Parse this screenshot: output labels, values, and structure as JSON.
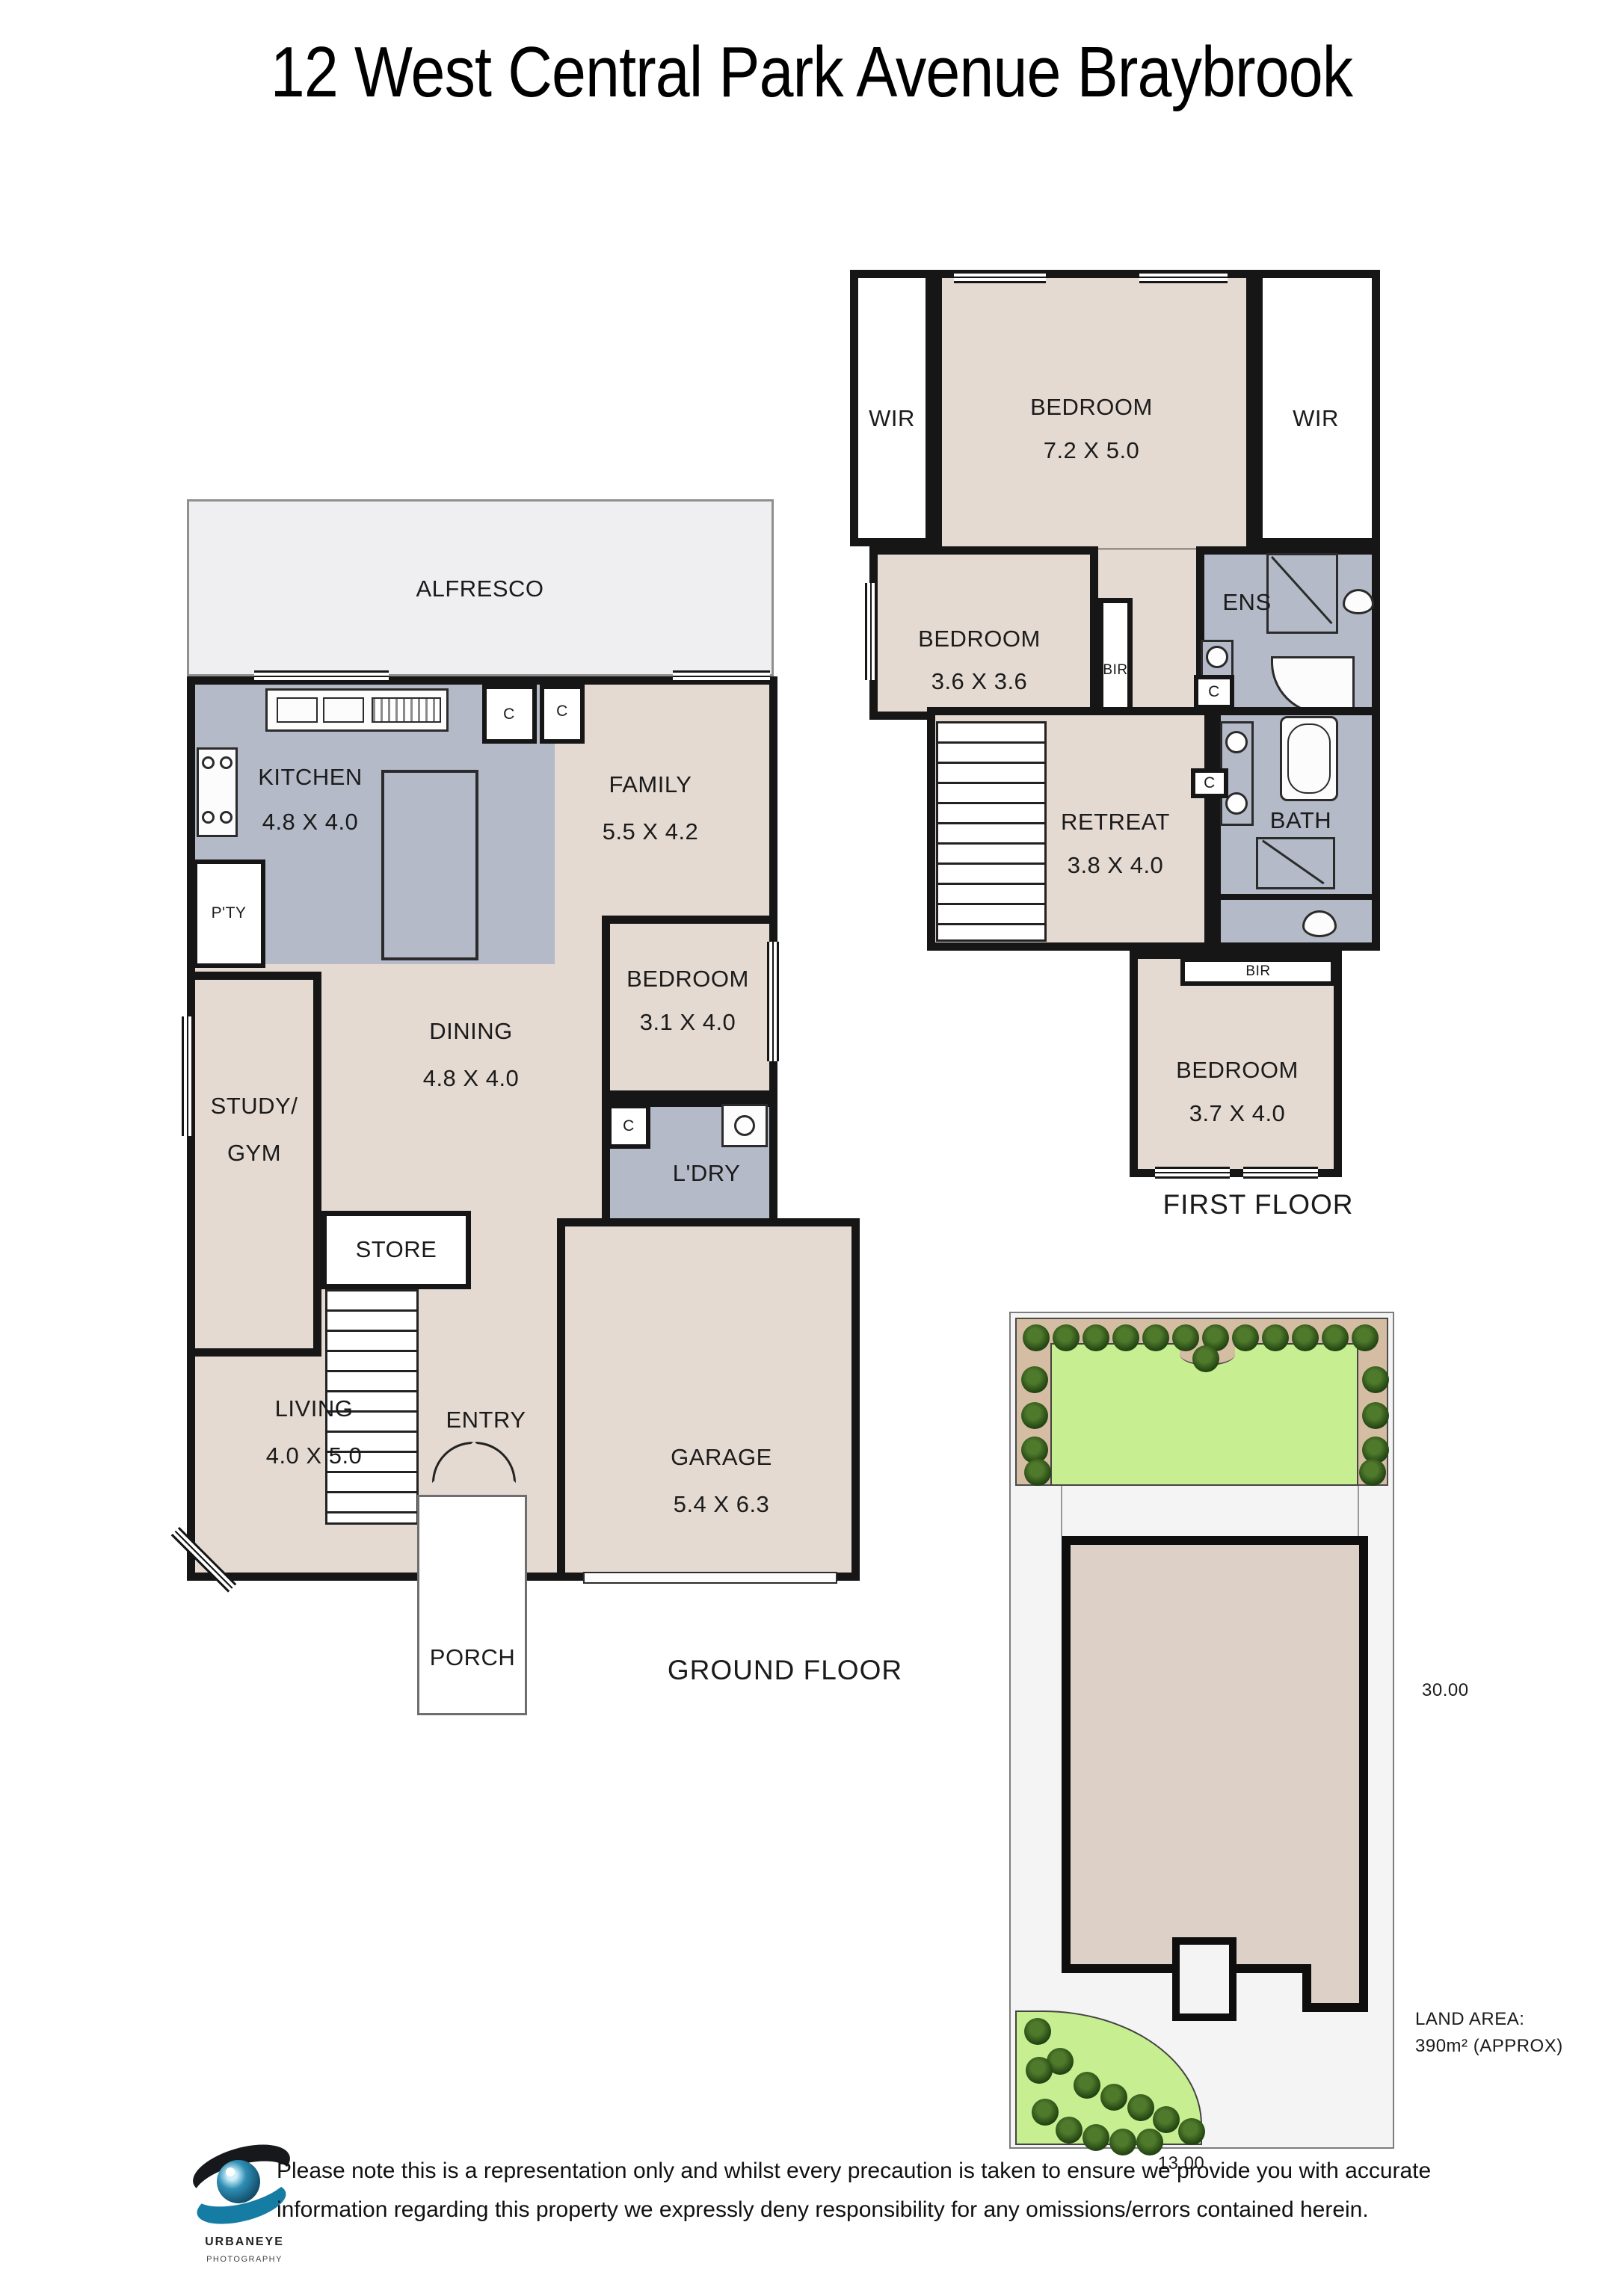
{
  "title": "12 West Central Park Avenue Braybrook",
  "first_floor": {
    "heading": "FIRST FLOOR",
    "wir_left": "WIR",
    "wir_right": "WIR",
    "bed_main": {
      "name": "BEDROOM",
      "dims": "7.2 X 5.0"
    },
    "bed2": {
      "name": "BEDROOM",
      "dims": "3.6 X 3.6"
    },
    "bir_top": "BIR",
    "ens": "ENS",
    "closet1": "C",
    "retreat": {
      "name": "RETREAT",
      "dims": "3.8 X 4.0"
    },
    "closet2": "C",
    "bath": "BATH",
    "bir_bottom": "BIR",
    "bed3": {
      "name": "BEDROOM",
      "dims": "3.7 X 4.0"
    }
  },
  "ground_floor": {
    "heading": "GROUND FLOOR",
    "alfresco": "ALFRESCO",
    "kitchen": {
      "name": "KITCHEN",
      "dims": "4.8 X 4.0"
    },
    "family": {
      "name": "FAMILY",
      "dims": "5.5 X 4.2"
    },
    "pantry": "P'TY",
    "closet1": "C",
    "closet2": "C",
    "dining": {
      "name": "DINING",
      "dims": "4.8 X 4.0"
    },
    "study": {
      "line1": "STUDY/",
      "line2": "GYM"
    },
    "bedroom": {
      "name": "BEDROOM",
      "dims": "3.1 X 4.0"
    },
    "laundry": "L'DRY",
    "closet3": "C",
    "store": "STORE",
    "living": {
      "name": "LIVING",
      "dims": "4.0 X 5.0"
    },
    "entry": "ENTRY",
    "garage": {
      "name": "GARAGE",
      "dims": "5.4 X 6.3"
    },
    "porch": "PORCH"
  },
  "site_plan": {
    "side_dimension": "30.00",
    "front_dimension": "13.00",
    "land_area_label": "LAND AREA:",
    "land_area_value": "390m² (APPROX)"
  },
  "footer": {
    "brand_name": "URBANEYE",
    "brand_sub": "PHOTOGRAPHY",
    "disclaimer_line1": "Please note this is a representation only and whilst every precaution is taken to ensure we provide you with accurate",
    "disclaimer_line2": "information regarding this property we expressly deny responsibility for any omissions/errors contained herein."
  },
  "colors": {
    "wall": "#161616",
    "floor": "#e5dad2",
    "wet_area": "#b4bac7",
    "outdoor": "#efeff1",
    "lawn": "#c7ef92",
    "garden_bed": "#d5bda4",
    "site_house": "#ddd1c7"
  }
}
